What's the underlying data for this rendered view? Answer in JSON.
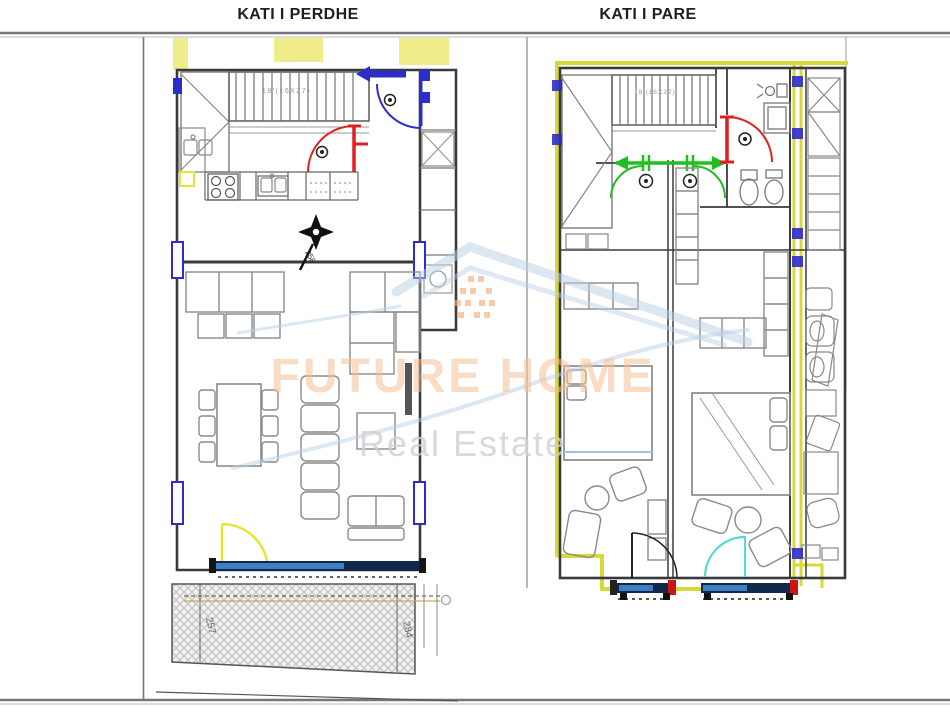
{
  "header": {
    "left_title": "KATI I PERDHE",
    "right_title": "KATI I PARE"
  },
  "ground_floor": {
    "stair_label": "18'(16X27)",
    "north_bearing": "258",
    "terrace_dim_left": "257",
    "terrace_dim_right": "284"
  },
  "first_floor": {
    "stair_label": "18'(16X27)"
  },
  "watermark": {
    "brand": "FUTURE HOME",
    "tagline": "Real Estate"
  },
  "colors": {
    "wall": "#3a3a3a",
    "door_red": "#e02020",
    "door_green": "#1fbf1f",
    "door_blue": "#2d2dcc",
    "door_yellow": "#e6e632",
    "door_cyan": "#56d8d8",
    "window_blue": "#2d2dcc",
    "sill_navy": "#10284a",
    "sill_blue": "#3f7ec2",
    "highlight_yellow": "#f0ec8a",
    "boundary_yellow": "#d8d838",
    "watermark_orange": "#f3c092",
    "watermark_blue": "#b9cfe6",
    "watermark_gray": "#d0d0d0"
  }
}
